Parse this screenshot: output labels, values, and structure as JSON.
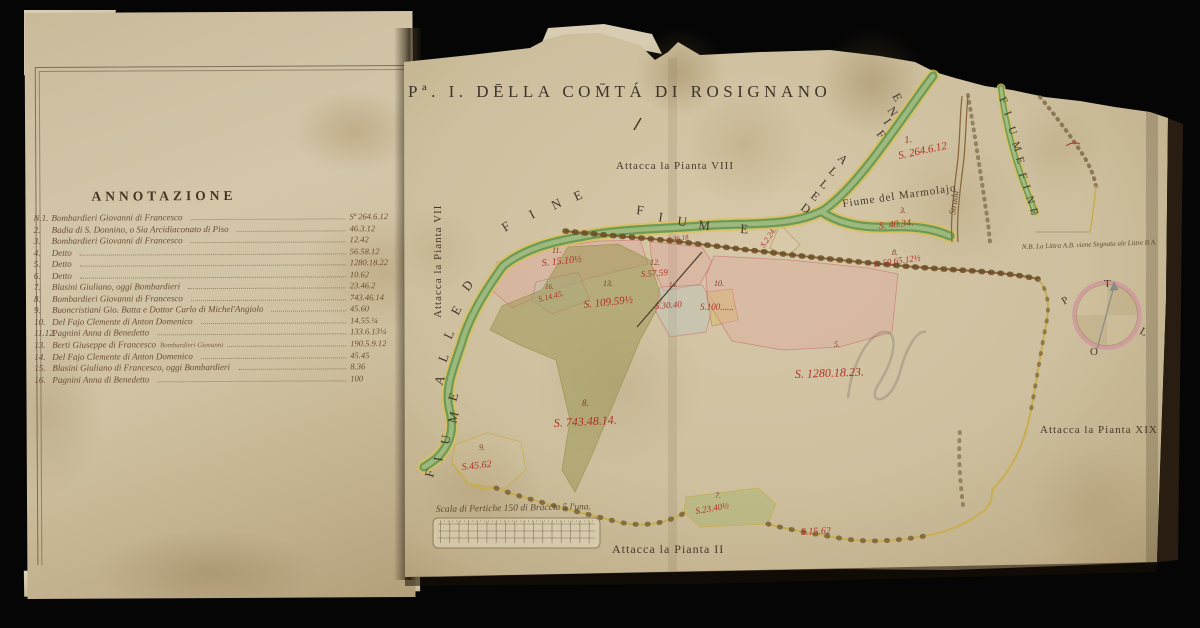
{
  "annotation": {
    "title": "ANNOTAZIONE",
    "entries": [
      {
        "no": "N.1.",
        "name": "Bombardieri Giovanni di Francesco",
        "sub": "",
        "value": "Sª 264.6.12"
      },
      {
        "no": "2.",
        "name": "Badia di S. Donnino, o Sia Arcidiaconato di Piso",
        "sub": "",
        "value": "46.3.12"
      },
      {
        "no": "3.",
        "name": "Bombardieri Giovanni di Francesco",
        "sub": "",
        "value": "12.42"
      },
      {
        "no": "4.",
        "name": "Detto",
        "sub": "",
        "value": "56.58.12"
      },
      {
        "no": "5.",
        "name": "Detto",
        "sub": "",
        "value": "1280.18.22"
      },
      {
        "no": "6.",
        "name": "Detto",
        "sub": "",
        "value": "10.62"
      },
      {
        "no": "7.",
        "name": "Blasini Giuliano, oggi Bombardieri",
        "sub": "",
        "value": "23.46.2"
      },
      {
        "no": "8.",
        "name": "Bombardieri Giovanni di Francesco",
        "sub": "",
        "value": "743.46.14"
      },
      {
        "no": "9.",
        "name": "Buoncristiani Gio. Batta e Dottor Carlo di Michel'Angiolo",
        "sub": "",
        "value": "45.60"
      },
      {
        "no": "10.",
        "name": "Del Fajo Clemente di Anton Domenico",
        "sub": "",
        "value": "14.55.¼"
      },
      {
        "no": "11.12.",
        "name": "Pagnini Anna di Benedetto",
        "sub": "",
        "value": "133.6.13¼"
      },
      {
        "no": "13.",
        "name": "Berti Giuseppe di Francesco",
        "sub": "Bombardieri Giovanni",
        "value": "190.5.9.12"
      },
      {
        "no": "14.",
        "name": "Del Fajo Clemente di Anton Domenico",
        "sub": "",
        "value": "45.45"
      },
      {
        "no": "15.",
        "name": "Blasini Giuliano di Francesco, oggi Bombardieri",
        "sub": "",
        "value": "8.36"
      },
      {
        "no": "16.",
        "name": "Pagnini Anna di Benedetto",
        "sub": "",
        "value": "100"
      }
    ]
  },
  "map": {
    "title": "Pª. I. DĒLLA COM̄TÁ DI ROSIGNANO",
    "texts": [
      {
        "t": "Attacca la Pianta VIII",
        "x": 616,
        "y": 169,
        "r": 0,
        "s": 11,
        "c": "ink",
        "ls": 1
      },
      {
        "t": "Attacca la Pianta VII",
        "x": 441,
        "y": 318,
        "r": -90,
        "s": 11,
        "c": "ink",
        "ls": 1
      },
      {
        "t": "Attacca la Pianta XIX",
        "x": 1040,
        "y": 433,
        "r": 0,
        "s": 11,
        "c": "ink",
        "ls": 1
      },
      {
        "t": "Attacca la Pianta II",
        "x": 612,
        "y": 553,
        "r": 0,
        "s": 12,
        "c": "ink",
        "ls": 1
      },
      {
        "t": "Fiume del Marmolajo",
        "x": 843,
        "y": 207,
        "r": -8,
        "s": 11,
        "c": "ink",
        "ls": 1
      },
      {
        "t": "Strada",
        "x": 955,
        "y": 215,
        "r": -82,
        "s": 9,
        "c": "script",
        "ls": 0
      },
      {
        "t": "N.B. La Littra A.B. viene Segnata ale Littre B.A.",
        "x": 1022,
        "y": 249,
        "r": -2,
        "s": 7,
        "c": "script",
        "ls": 0
      },
      {
        "t": "Scala di Pertiche 150 di Braccia 5 l'una.",
        "x": 436,
        "y": 512,
        "r": -1,
        "s": 9.5,
        "c": "script",
        "ls": 0
      }
    ],
    "red_labels": [
      {
        "t": "S. 264.6.12",
        "x": 899,
        "y": 159,
        "r": -12,
        "s": 11
      },
      {
        "t": "S.2.24.",
        "x": 764,
        "y": 248,
        "r": -55,
        "s": 8
      },
      {
        "t": "S. 40.34.",
        "x": 879,
        "y": 229,
        "r": -6,
        "s": 10
      },
      {
        "t": "S. 50.65.12½",
        "x": 874,
        "y": 267,
        "r": -8,
        "s": 9
      },
      {
        "t": "S. 15.10½",
        "x": 542,
        "y": 266,
        "r": -6,
        "s": 10
      },
      {
        "t": "S.14.45.",
        "x": 539,
        "y": 302,
        "r": -14,
        "s": 8
      },
      {
        "t": "S. 109.59½",
        "x": 584,
        "y": 308,
        "r": -6,
        "s": 11
      },
      {
        "t": "S.57.59",
        "x": 641,
        "y": 277,
        "r": -4,
        "s": 9
      },
      {
        "t": "S.30.40",
        "x": 655,
        "y": 309,
        "r": -4,
        "s": 9
      },
      {
        "t": "S.100......",
        "x": 700,
        "y": 310,
        "r": 0,
        "s": 9
      },
      {
        "t": "S.46.18",
        "x": 668,
        "y": 242,
        "r": -8,
        "s": 7
      },
      {
        "t": "S. 1280.18.23.",
        "x": 795,
        "y": 378,
        "r": -2,
        "s": 12
      },
      {
        "t": "S. 743.48.14.",
        "x": 554,
        "y": 427,
        "r": -3,
        "s": 12
      },
      {
        "t": "S.45.62",
        "x": 462,
        "y": 470,
        "r": -6,
        "s": 10
      },
      {
        "t": "S.23.40½",
        "x": 696,
        "y": 514,
        "r": -10,
        "s": 9
      },
      {
        "t": "S.15.62",
        "x": 801,
        "y": 535,
        "r": -3,
        "s": 10
      }
    ],
    "numbers": [
      {
        "t": "1.",
        "x": 905,
        "y": 143,
        "r": -10,
        "s": 10
      },
      {
        "t": "3.",
        "x": 900,
        "y": 213,
        "r": 0,
        "s": 8
      },
      {
        "t": "8.",
        "x": 892,
        "y": 255,
        "r": 0,
        "s": 8
      },
      {
        "t": "11.",
        "x": 552,
        "y": 253,
        "r": 0,
        "s": 8
      },
      {
        "t": "16.",
        "x": 545,
        "y": 289,
        "r": 0,
        "s": 7
      },
      {
        "t": "13.",
        "x": 603,
        "y": 286,
        "r": 0,
        "s": 8
      },
      {
        "t": "12.",
        "x": 650,
        "y": 265,
        "r": 0,
        "s": 8
      },
      {
        "t": "14.",
        "x": 669,
        "y": 287,
        "r": 0,
        "s": 7
      },
      {
        "t": "10.",
        "x": 714,
        "y": 286,
        "r": 0,
        "s": 8
      },
      {
        "t": "5.",
        "x": 834,
        "y": 347,
        "r": 0,
        "s": 8
      },
      {
        "t": "8.",
        "x": 582,
        "y": 406,
        "r": 0,
        "s": 9
      },
      {
        "t": "9.",
        "x": 479,
        "y": 450,
        "r": 0,
        "s": 8
      },
      {
        "t": "7.",
        "x": 715,
        "y": 498,
        "r": 0,
        "s": 8
      }
    ],
    "river_letters": [
      {
        "t": "F",
        "x": 505,
        "y": 232,
        "r": -32,
        "s": 13
      },
      {
        "t": "I",
        "x": 532,
        "y": 219,
        "r": -28,
        "s": 13
      },
      {
        "t": "N",
        "x": 554,
        "y": 210,
        "r": -26,
        "s": 13
      },
      {
        "t": "E",
        "x": 576,
        "y": 201,
        "r": -24,
        "s": 13
      },
      {
        "t": "F",
        "x": 636,
        "y": 214,
        "r": 6,
        "s": 13
      },
      {
        "t": "I",
        "x": 658,
        "y": 221,
        "r": 8,
        "s": 13
      },
      {
        "t": "U",
        "x": 677,
        "y": 225,
        "r": 8,
        "s": 13
      },
      {
        "t": "M",
        "x": 698,
        "y": 229,
        "r": 6,
        "s": 13
      },
      {
        "t": "E",
        "x": 740,
        "y": 233,
        "r": 4,
        "s": 13
      },
      {
        "t": "D",
        "x": 468,
        "y": 292,
        "r": -52,
        "s": 13
      },
      {
        "t": "E",
        "x": 458,
        "y": 316,
        "r": -60,
        "s": 13
      },
      {
        "t": "L",
        "x": 451,
        "y": 340,
        "r": -64,
        "s": 13
      },
      {
        "t": "L",
        "x": 446,
        "y": 363,
        "r": -68,
        "s": 13
      },
      {
        "t": "A",
        "x": 442,
        "y": 386,
        "r": -70,
        "s": 13
      },
      {
        "t": "E",
        "x": 456,
        "y": 402,
        "r": -72,
        "s": 13
      },
      {
        "t": "M",
        "x": 456,
        "y": 424,
        "r": -76,
        "s": 13
      },
      {
        "t": "U",
        "x": 449,
        "y": 445,
        "r": -80,
        "s": 13
      },
      {
        "t": "I",
        "x": 442,
        "y": 462,
        "r": -80,
        "s": 13
      },
      {
        "t": "F",
        "x": 433,
        "y": 478,
        "r": -76,
        "s": 13
      },
      {
        "t": "D",
        "x": 800,
        "y": 209,
        "r": 36,
        "s": 12
      },
      {
        "t": "E",
        "x": 810,
        "y": 197,
        "r": 38,
        "s": 12
      },
      {
        "t": "L",
        "x": 819,
        "y": 185,
        "r": 40,
        "s": 12
      },
      {
        "t": "L",
        "x": 828,
        "y": 172,
        "r": 42,
        "s": 12
      },
      {
        "t": "A",
        "x": 837,
        "y": 159,
        "r": 44,
        "s": 12
      },
      {
        "t": "F",
        "x": 876,
        "y": 134,
        "r": 52,
        "s": 12
      },
      {
        "t": "I",
        "x": 883,
        "y": 122,
        "r": 55,
        "s": 12
      },
      {
        "t": "N",
        "x": 887,
        "y": 110,
        "r": 57,
        "s": 12
      },
      {
        "t": "E",
        "x": 892,
        "y": 96,
        "r": 60,
        "s": 12
      },
      {
        "t": "F",
        "x": 999,
        "y": 99,
        "r": 64,
        "s": 11
      },
      {
        "t": "I",
        "x": 1004,
        "y": 113,
        "r": 67,
        "s": 11
      },
      {
        "t": "U",
        "x": 1008,
        "y": 128,
        "r": 70,
        "s": 11
      },
      {
        "t": "M",
        "x": 1012,
        "y": 143,
        "r": 71,
        "s": 11
      },
      {
        "t": "E",
        "x": 1016,
        "y": 158,
        "r": 72,
        "s": 11
      },
      {
        "t": "F",
        "x": 1019,
        "y": 174,
        "r": 73,
        "s": 11
      },
      {
        "t": "I",
        "x": 1023,
        "y": 186,
        "r": 74,
        "s": 11
      },
      {
        "t": "N",
        "x": 1026,
        "y": 197,
        "r": 74,
        "s": 11
      },
      {
        "t": "E",
        "x": 1030,
        "y": 209,
        "r": 75,
        "s": 11
      }
    ],
    "compass_points": [
      {
        "t": "T",
        "x": 1104,
        "y": 287,
        "r": 0,
        "s": 11
      },
      {
        "t": "P",
        "x": 1064,
        "y": 305,
        "r": -30,
        "s": 11
      },
      {
        "t": "L",
        "x": 1139,
        "y": 333,
        "r": 30,
        "s": 11
      },
      {
        "t": "O",
        "x": 1090,
        "y": 355,
        "r": 0,
        "s": 11
      }
    ]
  },
  "colors": {
    "paper": "#cfc1a1",
    "river_green": "#7fa863",
    "boundary_yellow": "#d9c05a",
    "parcel_pink": "#e2a49e",
    "parcel_olive": "#9e9a5c",
    "label_red": "#b03226",
    "ink_brown": "#4a3a2a"
  }
}
